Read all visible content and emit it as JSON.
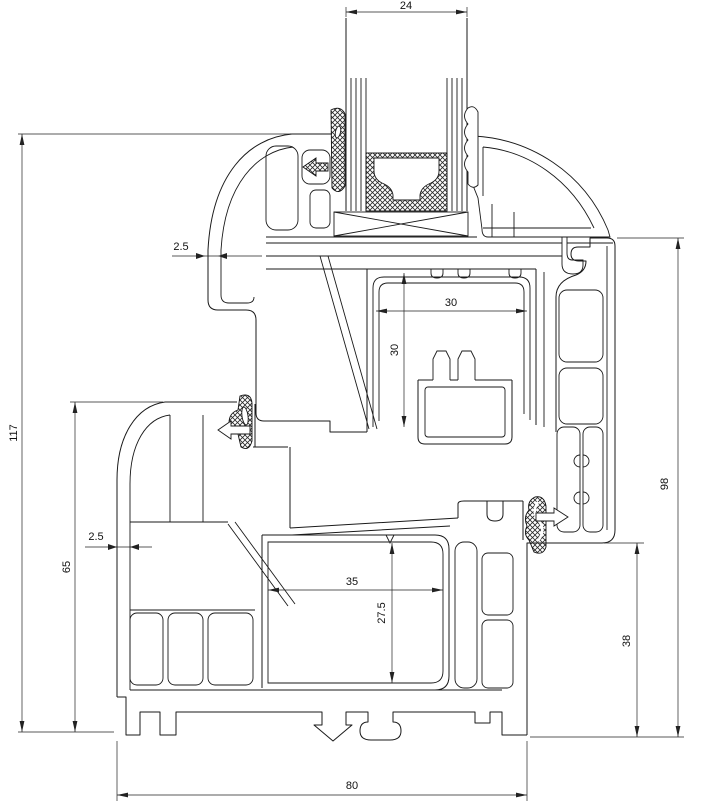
{
  "dims": {
    "d24": "24",
    "d25_upper": "2.5",
    "d117": "117",
    "d65": "65",
    "d25_lower": "2.5",
    "d30_width": "30",
    "d30_height": "30",
    "d35": "35",
    "d27_5": "27.5",
    "d98": "98",
    "d38": "38",
    "d80": "80"
  },
  "colors": {
    "line": "#1a1a1a",
    "dimension": "#222222",
    "background": "#ffffff"
  }
}
